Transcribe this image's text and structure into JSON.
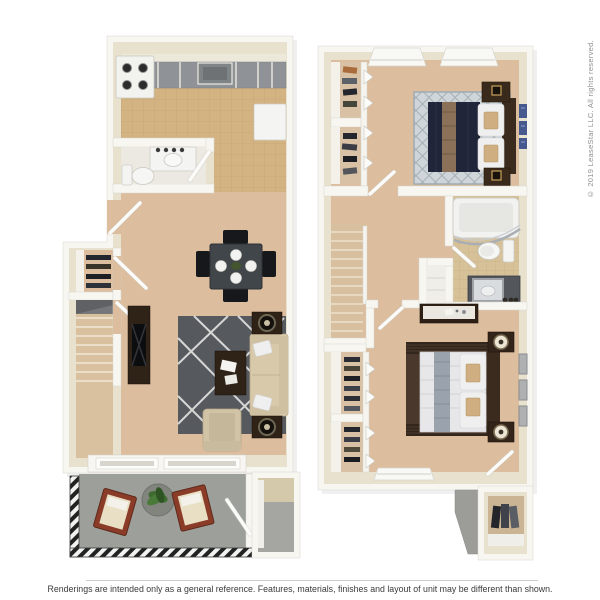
{
  "page": {
    "width": 600,
    "height": 600
  },
  "watermark": {
    "copyright": "© 2019 LeaseStar LLC. All rights reserved."
  },
  "footer": {
    "disclaimer": "Renderings are intended only as a general reference. Features, materials, finishes and layout of unit may be different than shown."
  },
  "floorplan": {
    "description": "3D top-down rendering of a two-story townhome floor plan, first floor on the left and second floor on the right",
    "floors": [
      {
        "id": "first-floor",
        "position": "left",
        "rooms": [
          "kitchen",
          "half-bathroom",
          "dining-area",
          "living-room",
          "entry-closet",
          "stairs",
          "patio",
          "outdoor-storage"
        ],
        "furniture": [
          "stove",
          "sink",
          "refrigerator",
          "vanity-sink",
          "toilet",
          "dining-table",
          "four-dining-chairs",
          "place-settings",
          "tv-console",
          "area-rug",
          "sofa",
          "coffee-table",
          "armchair",
          "end-tables-with-lamps",
          "sliding-glass-door",
          "patio-lounge-chairs",
          "planter-with-plant",
          "railing"
        ]
      },
      {
        "id": "second-floor",
        "position": "right",
        "rooms": [
          "bedroom-1",
          "bedroom-1-closets",
          "hallway",
          "stairs",
          "bathroom",
          "linen-closet",
          "bedroom-2",
          "bedroom-2-closets",
          "exterior-storage-closet"
        ],
        "furniture": [
          "queen-bed-navy",
          "diamond-area-rug",
          "nightstands-with-frames",
          "wall-art-blue",
          "bathtub",
          "toilet",
          "vanity-with-mirror",
          "dresser",
          "queen-bed-white",
          "striped-area-rug",
          "nightstands-with-lamps",
          "wall-art-frames",
          "hanging-clothes",
          "windows"
        ]
      }
    ]
  },
  "colors": {
    "background": "#ffffff",
    "wall": "#f7f6f1",
    "wall_top": "#e7e1cd",
    "carpet": "#dcbd9e",
    "kitchen_tile": "#d3b381",
    "bath_tile": "#d6c199",
    "patio_concrete": "#9da09a",
    "living_rug": "#565a5f",
    "bedroom1_rug": "#cfd5d8",
    "bedroom2_rug": "#4a382c",
    "sofa_tan": "#d8c9ab",
    "wood_dark": "#2f2318",
    "bed1_comforter_navy": "#212539",
    "bed1_runner_tan": "#8a7157",
    "bed2_comforter_white": "#e7e7e9",
    "bed2_runner_gray": "#9aa2ae",
    "accent_pillow_tan": "#cfae82",
    "plant_green": "#3e6b30",
    "patio_chair_red": "#8a3c28",
    "railing_black": "#222222",
    "art_blue": "#46598f",
    "divider_gray": "#cccccc",
    "disclaimer_text": "#3a3a3a",
    "copyright_text": "#8f8f8f"
  }
}
